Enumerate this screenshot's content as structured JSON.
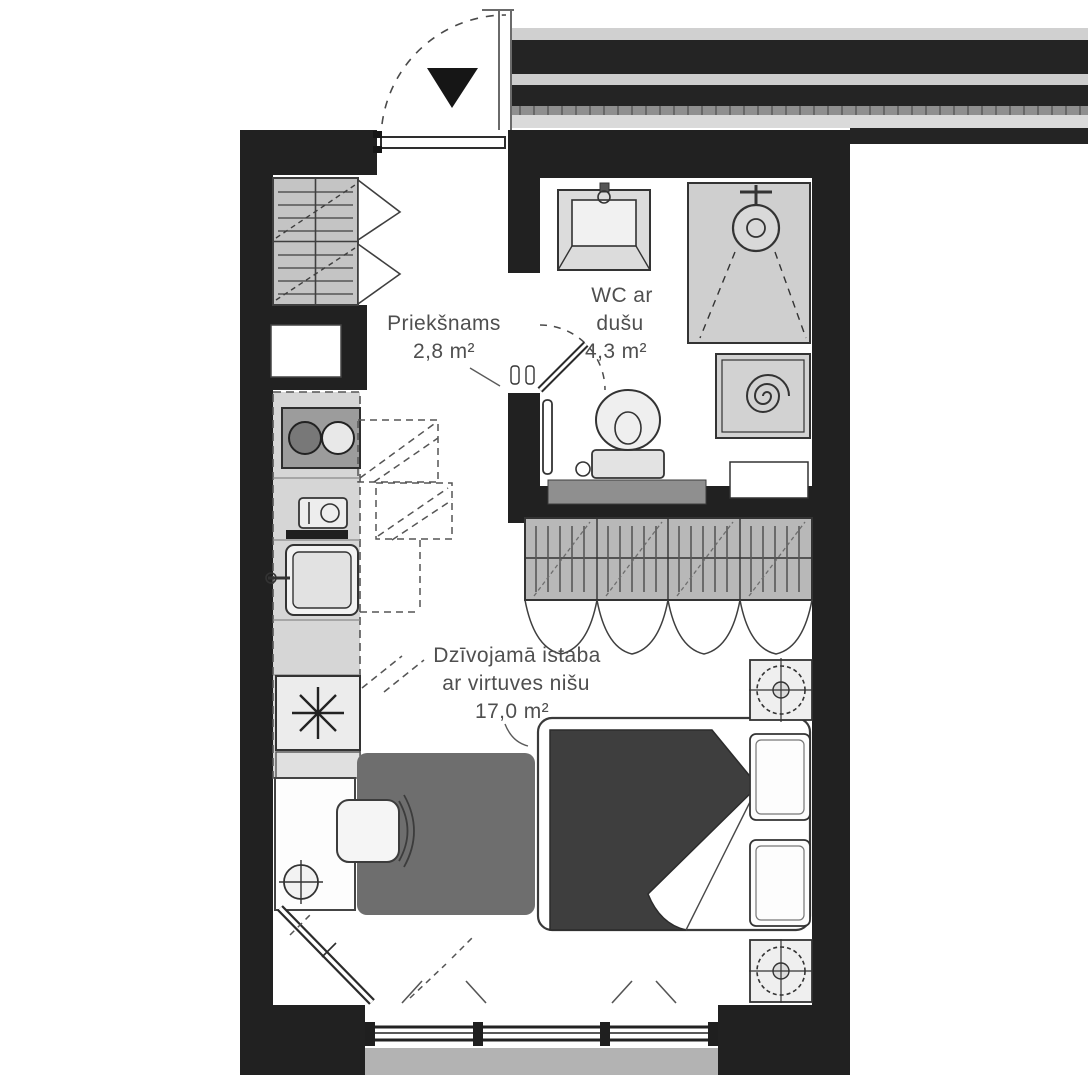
{
  "plan": {
    "type": "apartment-floor-plan",
    "language": "lv",
    "rooms": {
      "hallway": {
        "name": "Priekšnams",
        "area": "2,8 m²"
      },
      "bathroom": {
        "name_line1": "WC ar",
        "name_line2": "dušu",
        "area": "4,3 m²"
      },
      "living": {
        "name_line1": "Dzīvojamā istaba",
        "name_line2": "ar virtuves nišu",
        "area": "17,0 m²"
      }
    },
    "colors": {
      "wall": "#212121",
      "background": "#ffffff",
      "furniture_stroke": "#3c3c3c",
      "furniture_fill": "#ececec",
      "counter_fill": "#d6d6d6",
      "shade_gray": "#c6c6c6",
      "duvet": "#3e3e3e",
      "rug": "#6e6e6e",
      "label_text": "#4f4f4f"
    }
  }
}
